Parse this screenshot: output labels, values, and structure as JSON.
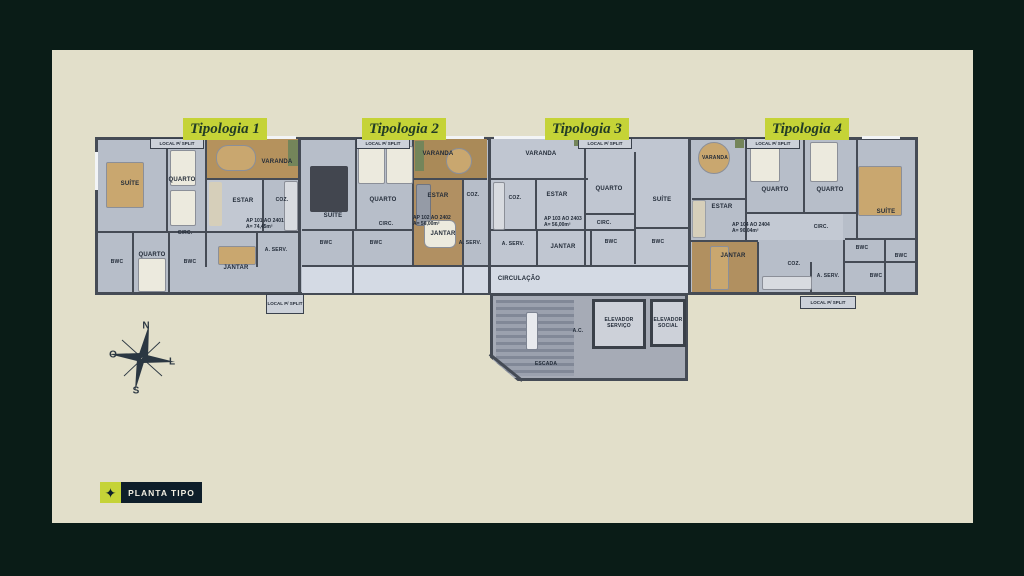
{
  "scene": {
    "badge": "PLANTA TIPO",
    "colors": {
      "background": "#0a1c17",
      "panel": "#e2dfca",
      "chip": "#c5d337",
      "chip_text": "#223c26",
      "badge_bar": "#0e1e2a",
      "badge_text": "#f2efe2",
      "wall": "#454b55",
      "floor": "#b7bec9",
      "wood_floor": "#b19062",
      "corridor": "#d4dae4"
    }
  },
  "typologies": [
    {
      "chip": "Tipologia 1",
      "ap": "AP 101 AO 2401",
      "area": "A= 74,45m²"
    },
    {
      "chip": "Tipologia 2",
      "ap": "AP 102 AO 2402",
      "area": "A= 56,00m²"
    },
    {
      "chip": "Tipologia 3",
      "ap": "AP 103 AO 2403",
      "area": "A= 56,00m²"
    },
    {
      "chip": "Tipologia 4",
      "ap": "AP 104 AO 2404",
      "area": "A= 90,04m²"
    }
  ],
  "labels": {
    "suite": "SUÍTE",
    "quarto": "QUARTO",
    "varanda": "VARANDA",
    "estar": "ESTAR",
    "coz": "COZ.",
    "circ": "CIRC.",
    "bwc": "BWC",
    "jantar": "JANTAR",
    "aserv": "A. SERV.",
    "split": "LOCAL P/ SPLIT",
    "circulacao": "CIRCULAÇÃO",
    "escada": "ESCADA",
    "ac": "A.C.",
    "elevador_servico": "ELEVADOR SERVIÇO",
    "elevador_social": "ELEVADOR SOCIAL"
  },
  "compass": {
    "north": "N",
    "south": "S",
    "west": "O",
    "east": "L"
  }
}
